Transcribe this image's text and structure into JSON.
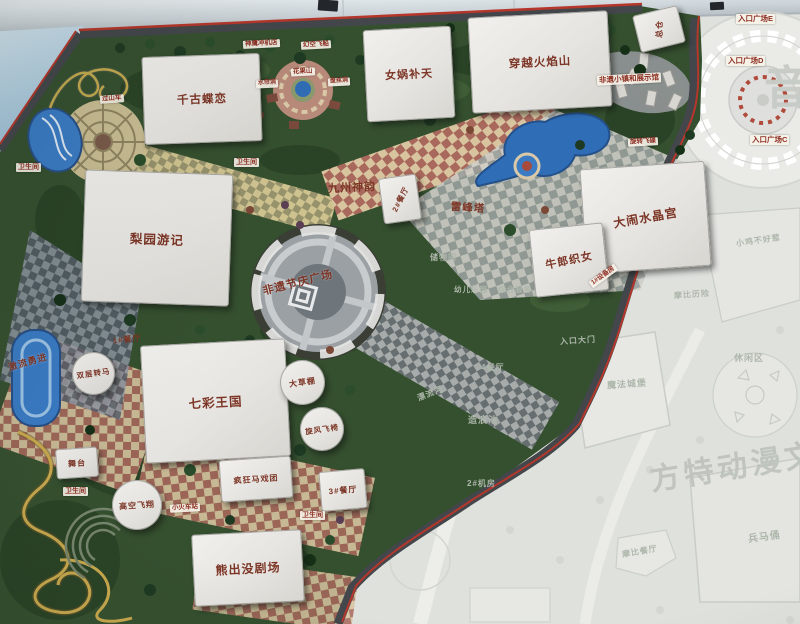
{
  "map": {
    "watermarks": {
      "main": "方特动漫文化科技",
      "corner": "音"
    },
    "buildings": [
      {
        "name": "building-qiangu-dielian",
        "label": "千古蝶恋",
        "kind": "building",
        "style": {
          "x": "143px",
          "y": "55px",
          "w": "118px",
          "h": "88px",
          "rot": "-2deg",
          "fs": "11.5px"
        }
      },
      {
        "name": "building-nvwa-butian",
        "label": "女娲补天",
        "kind": "building",
        "style": {
          "x": "365px",
          "y": "28px",
          "w": "88px",
          "h": "92px",
          "rot": "-3deg",
          "fs": "11px"
        }
      },
      {
        "name": "building-chuanyue-huoyanshan",
        "label": "穿越火焰山",
        "kind": "building",
        "style": {
          "x": "470px",
          "y": "14px",
          "w": "140px",
          "h": "96px",
          "rot": "-3deg",
          "fs": "11.5px"
        }
      },
      {
        "name": "building-zongcang",
        "label": "总仓",
        "kind": "building",
        "style": {
          "x": "636px",
          "y": "10px",
          "w": "46px",
          "h": "38px",
          "rot": "-14deg",
          "fs": "8px",
          "lrot": "-75deg"
        }
      },
      {
        "name": "building-jiuzhou-shenyun",
        "label": "九州神韵",
        "kind": "fan",
        "style": {
          "x": "312px",
          "y": "138px",
          "w": "80px",
          "h": "98px",
          "rot": "3deg",
          "fs": "11px",
          "lrot": "-6deg"
        }
      },
      {
        "name": "building-canting-2",
        "label": "2#餐厅",
        "kind": "building",
        "style": {
          "x": "381px",
          "y": "176px",
          "w": "38px",
          "h": "46px",
          "rot": "-8deg",
          "fs": "7.5px",
          "lrot": "-55deg"
        }
      },
      {
        "name": "building-leifengta",
        "label": "雷峰塔",
        "kind": "hex",
        "style": {
          "x": "436px",
          "y": "180px",
          "w": "64px",
          "h": "55px",
          "rot": "4deg",
          "fs": "10.5px"
        }
      },
      {
        "name": "building-danao-shuijinggong",
        "label": "大闹水晶宫",
        "kind": "building",
        "style": {
          "x": "583px",
          "y": "165px",
          "w": "125px",
          "h": "105px",
          "rot": "-4deg",
          "fs": "12px",
          "lrot": "-6deg"
        }
      },
      {
        "name": "building-niulang-zhinv",
        "label": "牛郎织女",
        "kind": "building",
        "style": {
          "x": "532px",
          "y": "226px",
          "w": "74px",
          "h": "68px",
          "rot": "-6deg",
          "fs": "11px",
          "lrot": "-6deg"
        }
      },
      {
        "name": "building-liyuan-youji",
        "label": "梨园游记",
        "kind": "building",
        "style": {
          "x": "83px",
          "y": "172px",
          "w": "148px",
          "h": "132px",
          "rot": "2deg",
          "fs": "12.5px"
        }
      },
      {
        "name": "building-qicai-wangguo",
        "label": "七彩王国",
        "kind": "building",
        "style": {
          "x": "143px",
          "y": "342px",
          "w": "145px",
          "h": "118px",
          "rot": "-3deg",
          "fs": "12.5px"
        }
      },
      {
        "name": "building-xiongchumo-juchang",
        "label": "熊出没剧场",
        "kind": "building",
        "style": {
          "x": "193px",
          "y": "532px",
          "w": "110px",
          "h": "72px",
          "rot": "-3deg",
          "fs": "12px"
        }
      },
      {
        "name": "building-fengkuang-maxituan",
        "label": "疯狂马戏团",
        "kind": "building",
        "style": {
          "x": "220px",
          "y": "458px",
          "w": "72px",
          "h": "42px",
          "rot": "-4deg",
          "fs": "8px"
        }
      },
      {
        "name": "building-canting-1",
        "label": "1#餐厅",
        "kind": "fan",
        "style": {
          "x": "101px",
          "y": "318px",
          "w": "52px",
          "h": "42px",
          "rot": "-6deg",
          "fs": "8px"
        }
      },
      {
        "name": "building-canting-3",
        "label": "3#餐厅",
        "kind": "building",
        "style": {
          "x": "320px",
          "y": "470px",
          "w": "46px",
          "h": "40px",
          "rot": "-5deg",
          "fs": "8px"
        }
      },
      {
        "name": "building-wutai",
        "label": "舞台",
        "kind": "building",
        "style": {
          "x": "56px",
          "y": "448px",
          "w": "42px",
          "h": "30px",
          "rot": "-4deg",
          "fs": "8px"
        }
      },
      {
        "name": "ride-shuangceng-zhuanma",
        "label": "双层转马",
        "kind": "building circle",
        "style": {
          "x": "72px",
          "y": "352px",
          "w": "43px",
          "h": "43px",
          "fs": "7.5px",
          "lrot": "-8deg"
        }
      },
      {
        "name": "ride-dacaopeng",
        "label": "大草棚",
        "kind": "building circle",
        "style": {
          "x": "280px",
          "y": "360px",
          "w": "45px",
          "h": "45px",
          "fs": "8px",
          "lrot": "-8deg"
        }
      },
      {
        "name": "ride-xuanfeng-feiyi",
        "label": "旋风飞椅",
        "kind": "building circle",
        "style": {
          "x": "300px",
          "y": "407px",
          "w": "44px",
          "h": "44px",
          "fs": "7.5px",
          "lrot": "-8deg"
        }
      },
      {
        "name": "ride-gaokong-feixiang",
        "label": "高空飞翔",
        "kind": "building circle",
        "style": {
          "x": "112px",
          "y": "480px",
          "w": "50px",
          "h": "50px",
          "fs": "8px",
          "lrot": "-4deg"
        }
      }
    ],
    "labels": [
      {
        "name": "label-guoshanche",
        "label": "过山车",
        "kind": "tag",
        "style": {
          "x": "100px",
          "y": "95px",
          "fs": "6.5px",
          "rot": "-4deg"
        }
      },
      {
        "name": "label-shenying-chongjidian",
        "label": "神鹰冲机店",
        "kind": "tag",
        "style": {
          "x": "243px",
          "y": "40px",
          "fs": "6.5px",
          "rot": "-3deg"
        }
      },
      {
        "name": "label-huankong-feichuan",
        "label": "幻空飞船",
        "kind": "tag",
        "style": {
          "x": "301px",
          "y": "41px",
          "fs": "6.5px",
          "rot": "-3deg"
        }
      },
      {
        "name": "label-shuiliandong",
        "label": "水帘洞",
        "kind": "tag",
        "style": {
          "x": "256px",
          "y": "80px",
          "fs": "6px",
          "rot": "-3deg"
        }
      },
      {
        "name": "label-huaguoshan",
        "label": "花果山",
        "kind": "tag",
        "style": {
          "x": "291px",
          "y": "68px",
          "fs": "6.5px",
          "rot": "-3deg"
        }
      },
      {
        "name": "label-pansidong",
        "label": "盘丝洞",
        "kind": "tag",
        "style": {
          "x": "328px",
          "y": "78px",
          "fs": "6px",
          "rot": "-3deg"
        }
      },
      {
        "name": "label-wc-liyuan-west",
        "label": "卫生间",
        "kind": "tag",
        "style": {
          "x": "16px",
          "y": "163px",
          "fs": "7px"
        }
      },
      {
        "name": "label-wc-liyuan-east",
        "label": "卫生间",
        "kind": "tag",
        "style": {
          "x": "234px",
          "y": "158px",
          "fs": "7px"
        }
      },
      {
        "name": "label-wc-wutai",
        "label": "卫生间",
        "kind": "tag",
        "style": {
          "x": "63px",
          "y": "487px",
          "fs": "7px"
        }
      },
      {
        "name": "label-wc-xiongchumo",
        "label": "卫生间",
        "kind": "tag",
        "style": {
          "x": "300px",
          "y": "511px",
          "fs": "7px"
        }
      },
      {
        "name": "label-feiyi-xiaozhen",
        "label": "非遗小镇和展示馆",
        "kind": "tag",
        "style": {
          "x": "597px",
          "y": "74px",
          "fs": "7.5px",
          "rot": "-3deg"
        }
      },
      {
        "name": "label-rukou-guangchang-e",
        "label": "入口广场E",
        "kind": "tag",
        "style": {
          "x": "736px",
          "y": "14px",
          "fs": "7.5px"
        }
      },
      {
        "name": "label-rukou-guangchang-d",
        "label": "入口广场D",
        "kind": "tag",
        "style": {
          "x": "726px",
          "y": "56px",
          "fs": "7.5px"
        }
      },
      {
        "name": "label-rukou-guangchang-c",
        "label": "入口广场C",
        "kind": "tag",
        "style": {
          "x": "750px",
          "y": "135px",
          "fs": "7.5px"
        }
      },
      {
        "name": "label-xiaohuoche",
        "label": "小火车站",
        "kind": "tag",
        "style": {
          "x": "170px",
          "y": "504px",
          "fs": "6.5px",
          "rot": "-3deg"
        }
      },
      {
        "name": "label-jiliu-yongjin",
        "label": "激流勇进",
        "kind": "maplabel",
        "style": {
          "x": "8px",
          "y": "357px",
          "fs": "9px",
          "rot": "-16deg"
        }
      },
      {
        "name": "label-shebeifang",
        "label": "1#设备房",
        "kind": "tag",
        "style": {
          "x": "588px",
          "y": "272px",
          "fs": "6.5px",
          "rot": "-36deg"
        }
      },
      {
        "name": "label-xuanzhuan-feidie",
        "label": "旋转飞碟",
        "kind": "tag",
        "style": {
          "x": "628px",
          "y": "138px",
          "fs": "6.5px",
          "rot": "-3deg"
        }
      },
      {
        "name": "label-feiyi-jieqing-guangchang",
        "label": "非遗节庆广场",
        "kind": "maplabel",
        "style": {
          "x": "262px",
          "y": "276px",
          "fs": "11px",
          "rot": "-14deg"
        }
      },
      {
        "name": "label-chuwujian",
        "label": "储物间",
        "kind": "faded",
        "style": {
          "x": "430px",
          "y": "253px",
          "fs": "8px"
        }
      },
      {
        "name": "label-youer-leyuan",
        "label": "幼儿乐园",
        "kind": "faded",
        "style": {
          "x": "454px",
          "y": "285px",
          "fs": "7.5px"
        }
      },
      {
        "name": "label-zonghe-fuwu",
        "label": "综合服务",
        "kind": "faded",
        "style": {
          "x": "498px",
          "y": "285px",
          "fs": "7.5px"
        }
      },
      {
        "name": "label-canting-4",
        "label": "4餐厅",
        "kind": "faded",
        "style": {
          "x": "481px",
          "y": "363px",
          "fs": "8px"
        }
      },
      {
        "name": "label-piaoliuhe",
        "label": "漂流河",
        "kind": "faded",
        "style": {
          "x": "417px",
          "y": "389px",
          "fs": "8px",
          "rot": "-22deg"
        }
      },
      {
        "name": "label-zaolangchi",
        "label": "造浪池",
        "kind": "faded",
        "style": {
          "x": "468px",
          "y": "415px",
          "fs": "9px"
        }
      },
      {
        "name": "label-jifang-2",
        "label": "2#机房",
        "kind": "faded",
        "style": {
          "x": "467px",
          "y": "479px",
          "fs": "8px"
        }
      },
      {
        "name": "label-rukou-damen",
        "label": "入口大门",
        "kind": "faded",
        "style": {
          "x": "560px",
          "y": "336px",
          "fs": "8px",
          "rot": "-4deg"
        }
      },
      {
        "name": "label-mofa-chengbao",
        "label": "魔法城堡",
        "kind": "faded",
        "style": {
          "x": "607px",
          "y": "379px",
          "fs": "9px",
          "rot": "-4deg"
        }
      },
      {
        "name": "label-xiuxianqu",
        "label": "休闲区",
        "kind": "faded",
        "style": {
          "x": "734px",
          "y": "353px",
          "fs": "9px"
        }
      },
      {
        "name": "label-xiaoji-buhaore",
        "label": "小鸡不好惹",
        "kind": "faded",
        "style": {
          "x": "736px",
          "y": "236px",
          "fs": "8px",
          "rot": "-8deg"
        }
      },
      {
        "name": "label-mobi-lixian",
        "label": "摩比历险",
        "kind": "faded",
        "style": {
          "x": "674px",
          "y": "290px",
          "fs": "8px",
          "rot": "-4deg"
        }
      },
      {
        "name": "label-bingmayong",
        "label": "兵马俑",
        "kind": "faded",
        "style": {
          "x": "748px",
          "y": "531px",
          "fs": "10px",
          "rot": "-8deg"
        }
      },
      {
        "name": "label-mobi-canting",
        "label": "摩比餐厅",
        "kind": "faded",
        "style": {
          "x": "622px",
          "y": "547px",
          "fs": "8px",
          "rot": "-10deg"
        }
      }
    ],
    "accent_colors": {
      "map_border_red": "#b5372b",
      "label_red": "#8d2f23",
      "water_blue": "#2f6db6"
    }
  }
}
